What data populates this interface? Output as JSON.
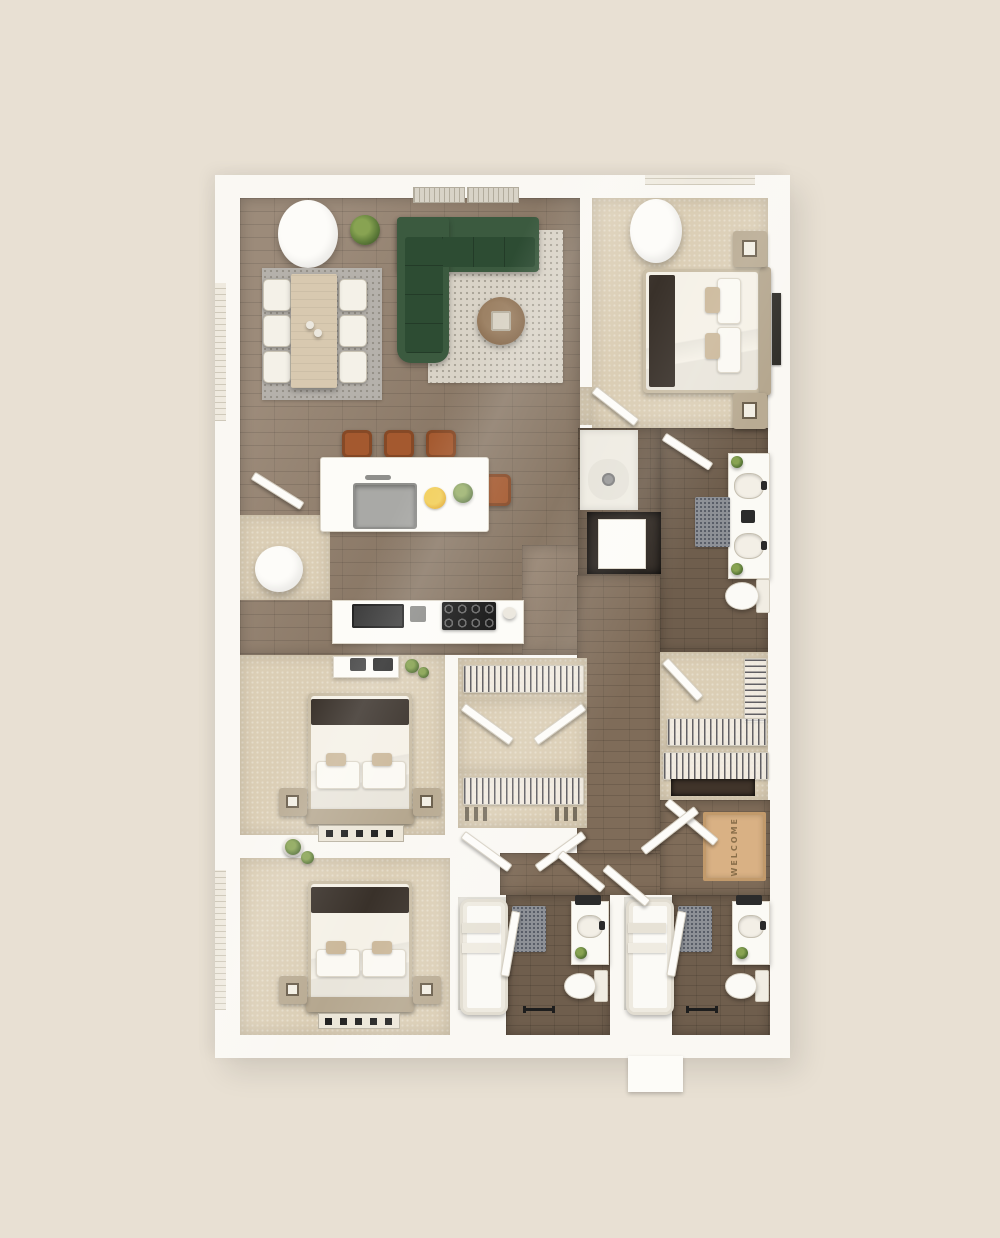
{
  "labels": {
    "doormat": "WELCOME"
  },
  "palette": {
    "canvas": "#e8e0d3",
    "wall": "#faf8f3",
    "wood": "#917e6b",
    "hallWood": "#7f6c59",
    "carpet": "#dbceb5",
    "tile": "#6f5e4d",
    "sofa": "#3b5a3f",
    "sofaCushion": "#2d4c33",
    "areaRug": "#d9d3c7",
    "diningRug": "#b5b1ab",
    "stool": "#a4592f",
    "coffeeTable": "#86694c",
    "mat": "#d9b184",
    "matText": "#8a6f4a",
    "throw": "#39312a",
    "headboard": "#b5a78f",
    "appliance": "#1c1c1c",
    "fruit": "#e2a92e",
    "plant": "#5f7d3a",
    "bathMat": "#8d9096"
  },
  "inventory": [
    "dining-table-with-six-chairs",
    "green-l-sectional-sofa",
    "round-coffee-table",
    "living-area-rug",
    "kitchen-island-with-sink",
    "four-bar-stools",
    "cooktop-counter",
    "dark-appliance",
    "primary-bed",
    "two-guest-beds",
    "six-nightstands",
    "slipper-rugs",
    "walk-in-shower",
    "washer-dryer-closet",
    "double-sink-vanity",
    "three-toilets",
    "two-bathtubs",
    "walk-in-closet-hangers",
    "three-reach-in-closets",
    "welcome-doormat",
    "potted-plants",
    "two-round-columns",
    "wall-art"
  ]
}
